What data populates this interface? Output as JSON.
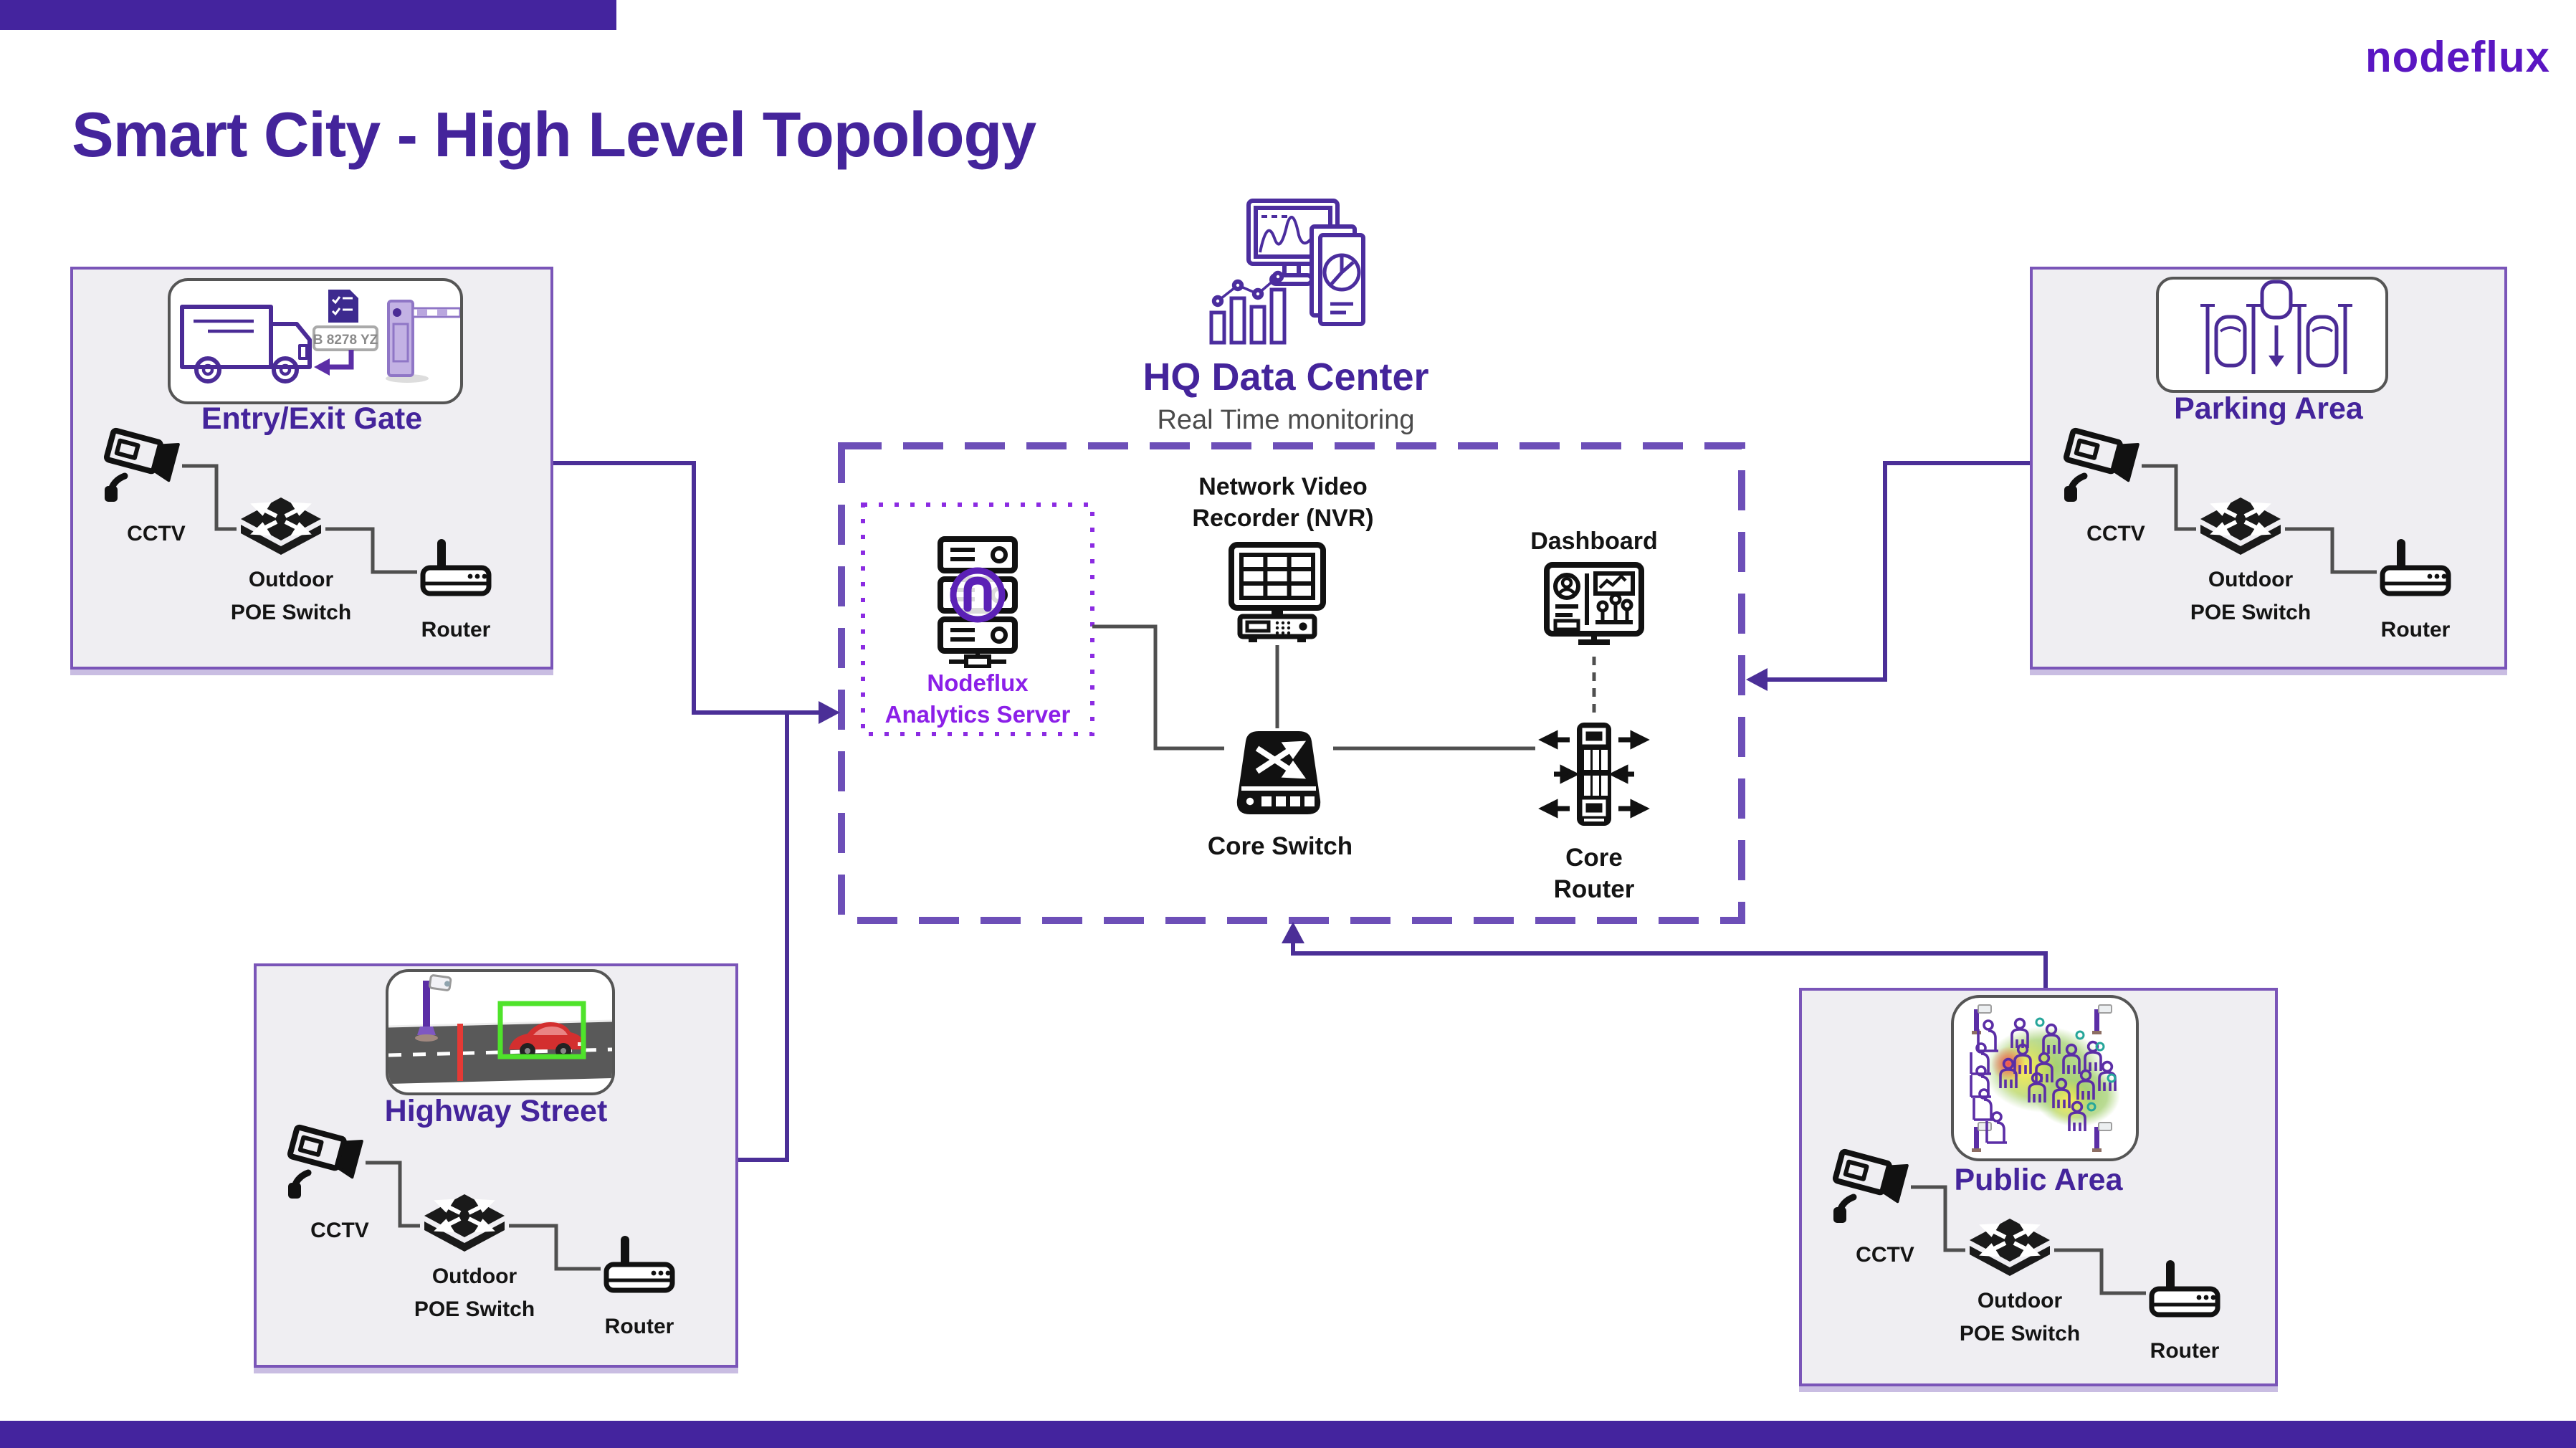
{
  "page": {
    "title": "Smart City - High Level Topology"
  },
  "brand": {
    "wordmark": "nodeflux"
  },
  "hq": {
    "title": "HQ Data Center",
    "subtitle": "Real Time monitoring",
    "analytics_server": {
      "line1": "Nodeflux",
      "line2": "Analytics Server"
    },
    "nvr": {
      "line1": "Network Video",
      "line2": "Recorder (NVR)"
    },
    "dashboard_label": "Dashboard",
    "core_switch_label": "Core Switch",
    "core_router": {
      "line1": "Core",
      "line2": "Router"
    }
  },
  "sites": [
    {
      "id": "entry-exit-gate",
      "title": "Entry/Exit Gate",
      "camera_label": "CCTV",
      "switch_label_line1": "Outdoor",
      "switch_label_line2": "POE Switch",
      "router_label": "Router",
      "license_plate": "B 8278 YZ"
    },
    {
      "id": "parking-area",
      "title": "Parking Area",
      "camera_label": "CCTV",
      "switch_label_line1": "Outdoor",
      "switch_label_line2": "POE Switch",
      "router_label": "Router"
    },
    {
      "id": "highway-street",
      "title": "Highway Street",
      "camera_label": "CCTV",
      "switch_label_line1": "Outdoor",
      "switch_label_line2": "POE Switch",
      "router_label": "Router"
    },
    {
      "id": "public-area",
      "title": "Public Area",
      "camera_label": "CCTV",
      "switch_label_line1": "Outdoor",
      "switch_label_line2": "POE Switch",
      "router_label": "Router"
    }
  ],
  "colors": {
    "accent_purple": "#44249b",
    "brand_purple": "#5a16c2",
    "violet_label": "#8b1fe8",
    "hq_dashed_border": "#6d4fb8",
    "dotted_border": "#8b2be2",
    "connector_purple": "#4b2f97",
    "site_border": "#7a55b8",
    "wire_gray": "#4f4f4f",
    "site_background": "#efeef2"
  }
}
